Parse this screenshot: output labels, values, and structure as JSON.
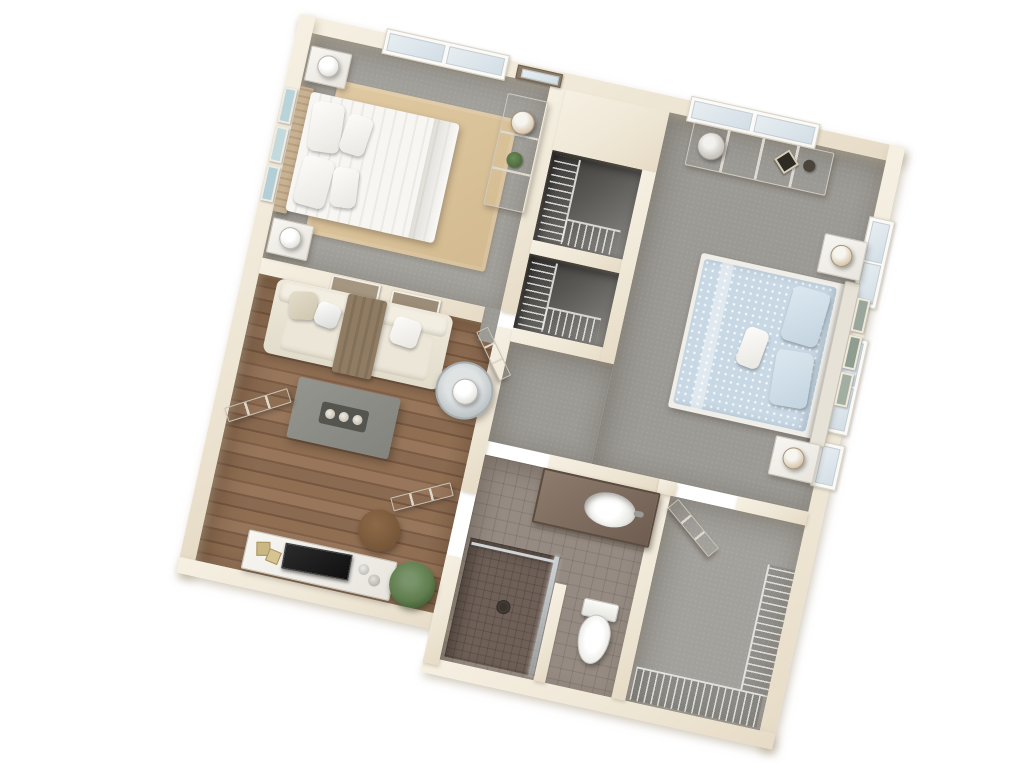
{
  "meta": {
    "title": "3D Apartment Floor Plan",
    "view": "top-down 3D render",
    "bedrooms": "2",
    "bathrooms": "1",
    "background_color": "#ffffff"
  },
  "palette": {
    "wall": "#efe7d6",
    "wall_shadow": "#e6dbc6",
    "carpet_gray": "#a3a19c",
    "wood_floor": "#8a6a4f",
    "area_rug_tan": "#d9c29a",
    "bath_tile": "#968b82",
    "shower_tile": "#6e6057",
    "closet_dark": "#4a4846",
    "white_furniture": "#f3f1ed",
    "bed1_bedding": "#f5f4f1",
    "bed2_bedding": "#c8d8e4",
    "sofa": "#e9e3d5",
    "throw_blanket": "#8d7a62",
    "coffee_table": "#8e8e88",
    "tv": "#1f1f1f",
    "plant": "#5f7d4e",
    "ottoman": "#7c5a3c",
    "toilet": "#f6f6f4",
    "art_blue": "#b9d3da",
    "art_sage": "#9aa69b",
    "headboard_tan": "#c8b294"
  },
  "rooms": [
    {
      "name": "Bedroom 1",
      "floor": "gray carpet",
      "furniture": [
        "bed with white striped bedding",
        "woven headboard",
        "nightstand x2",
        "white table lamp x2",
        "tan area rug",
        "dresser",
        "dresser lamp",
        "potted plant",
        "wall mirror",
        "blue wall art x3",
        "window"
      ]
    },
    {
      "name": "Bedroom 2",
      "floor": "gray carpet",
      "furniture": [
        "bed with blue patterned bedding",
        "nightstand x2",
        "table lamp x2",
        "dresser with glass lamp",
        "diamond picture frame",
        "sage wall art x3",
        "window x3"
      ]
    },
    {
      "name": "Living Room",
      "floor": "wood plank",
      "furniture": [
        "sofa",
        "throw blanket",
        "throw pillow x2",
        "coffee table with candle tray",
        "round side table with lamp",
        "media console",
        "tv",
        "gold decor frames",
        "potted plant",
        "brown ottoman",
        "entry door",
        "wall art x2"
      ]
    },
    {
      "name": "Hallway",
      "floor": "gray carpet",
      "furniture": [
        "bedroom door"
      ]
    },
    {
      "name": "Hall Closet A",
      "floor": "dark",
      "furniture": [
        "wire shelving"
      ]
    },
    {
      "name": "Hall Closet B",
      "floor": "dark",
      "furniture": [
        "wire shelving"
      ]
    },
    {
      "name": "Bathroom",
      "floor": "ceramic tile",
      "furniture": [
        "vanity with oval sink",
        "walk-in shower",
        "shower glass",
        "toilet",
        "privacy partition",
        "bathroom door"
      ]
    },
    {
      "name": "Walk-in Closet",
      "floor": "gray carpet",
      "furniture": [
        "wire shelving runs",
        "closet door"
      ]
    }
  ]
}
